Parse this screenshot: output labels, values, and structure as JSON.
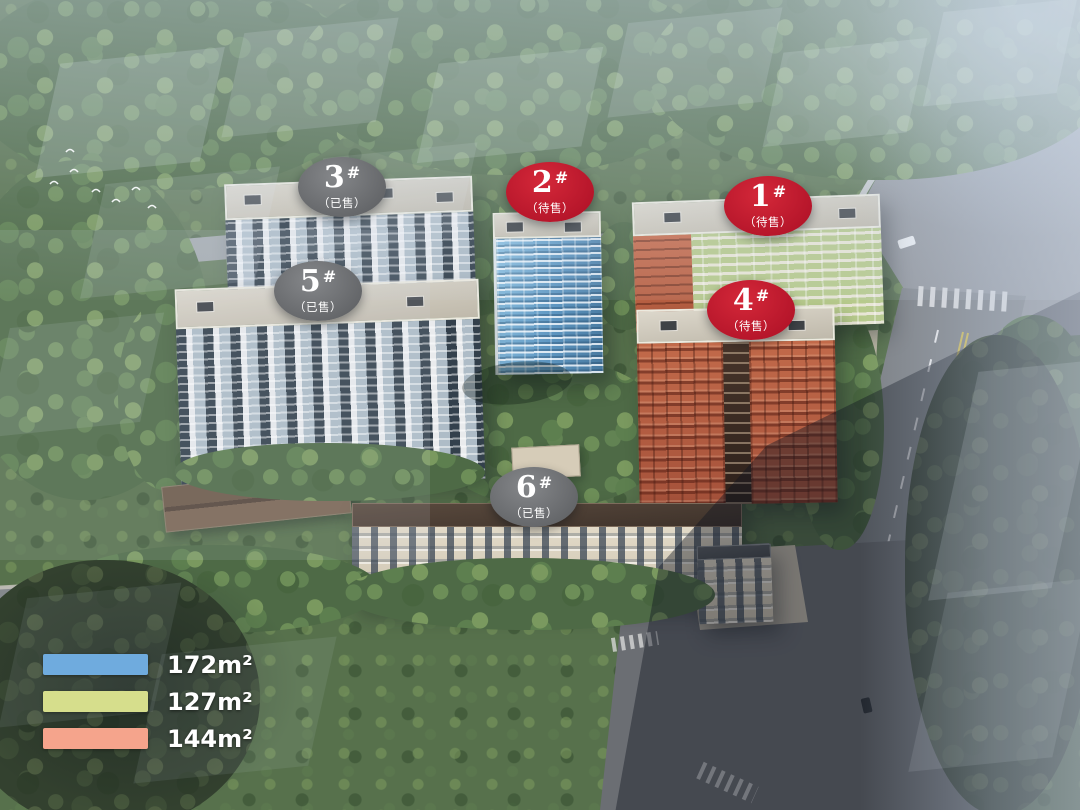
{
  "buildings": [
    {
      "num": "3",
      "hash": "#",
      "status": "（已售）"
    },
    {
      "num": "2",
      "hash": "#",
      "status": "（待售）"
    },
    {
      "num": "1",
      "hash": "#",
      "status": "（待售）"
    },
    {
      "num": "5",
      "hash": "#",
      "status": "（已售）"
    },
    {
      "num": "4",
      "hash": "#",
      "status": "（待售）"
    },
    {
      "num": "6",
      "hash": "#",
      "status": "（已售）"
    }
  ],
  "legend": {
    "items": [
      {
        "label": "172m²",
        "color": "#6fabde"
      },
      {
        "label": "127m²",
        "color": "#d6de8c"
      },
      {
        "label": "144m²",
        "color": "#f5a48c"
      }
    ]
  },
  "colors": {
    "badge_sold_gray": "#717376",
    "badge_forsale_red": "#c21f2e"
  }
}
